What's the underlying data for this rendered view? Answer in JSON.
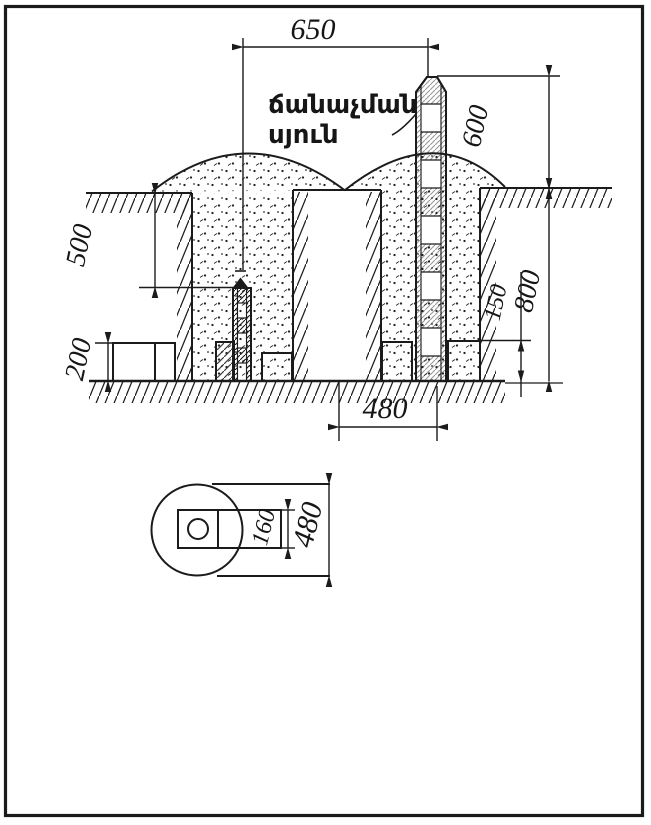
{
  "figure": {
    "kind": "geodetic-monument-installation-drawing",
    "label": {
      "line1": "ճանաչման",
      "line2": "սյուն"
    },
    "dimensions": {
      "marker_to_post_spacing": "650",
      "post_height_above_ground": "600",
      "marker_depth": "500",
      "ledge_block_height": "200",
      "anchor_top_to_bottom": "150",
      "pit_depth": "800",
      "pit_bottom_width": "480",
      "plan_anchor_width": "160",
      "plan_pit_width": "480"
    },
    "colors": {
      "ink": "#1b1b1b",
      "paper": "#ffffff"
    }
  }
}
